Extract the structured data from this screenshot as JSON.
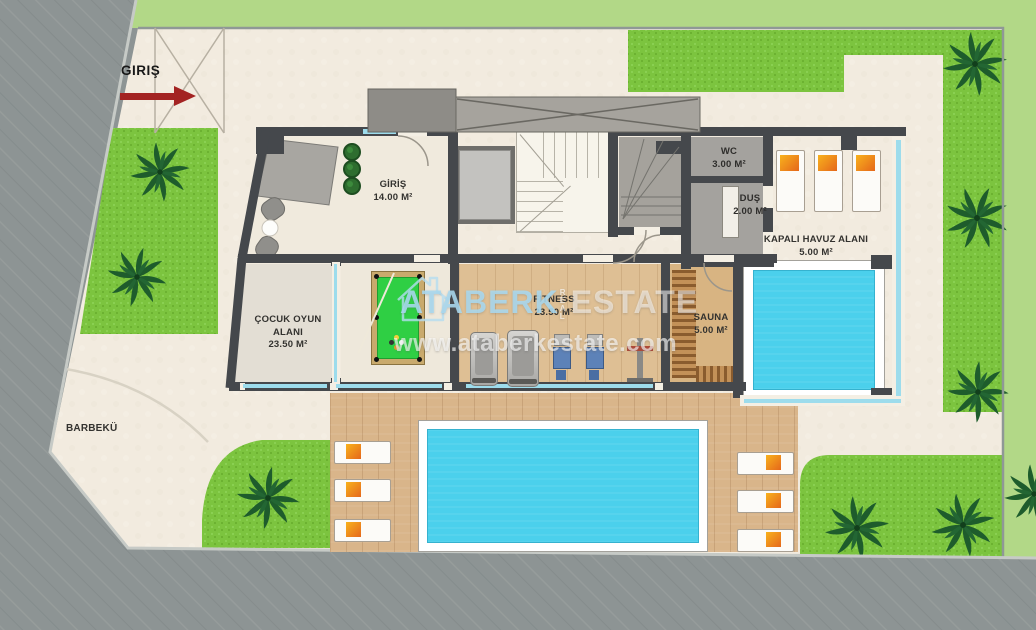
{
  "entrance": {
    "label": "GIRIŞ"
  },
  "rooms": {
    "giris": {
      "name": "GİRİŞ",
      "area": "14.00 M²"
    },
    "wc": {
      "name": "WC",
      "area": "3.00 M²"
    },
    "dus": {
      "name": "DUŞ",
      "area": "2.00 M²"
    },
    "kapali_havuz": {
      "name": "KAPALI HAVUZ ALANI",
      "area": "5.00 M²"
    },
    "cocuk_oyun": {
      "line1": "ÇOCUK OYUN",
      "line2": "ALANI",
      "area": "23.50 M²"
    },
    "fitness": {
      "name": "FITNESS",
      "area": "23.50 M²"
    },
    "sauna": {
      "name": "SAUNA",
      "area": "5.00 M²"
    }
  },
  "outdoor": {
    "barbecue": "BARBEKÜ"
  },
  "watermark": {
    "brand": "ATABERK",
    "real": "REAL",
    "estate": "ESTATE",
    "url": "www.ataberkestate.com"
  },
  "colors": {
    "pool_water": "#4bd0ec",
    "grass": "#7cc43f",
    "road": "#8d9494",
    "outer_green": "#b2d887",
    "cream_paving": "#f2ebdf",
    "wall": "#45484c",
    "wood_deck": "#d9b58a",
    "accent_red": "#a32322",
    "watermark_blue": "#a8d8ef"
  }
}
